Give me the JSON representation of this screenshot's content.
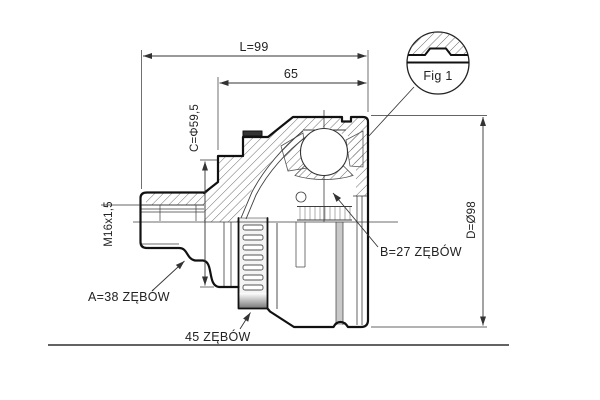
{
  "drawing": {
    "title_dimensions": {
      "length_total": "L=99",
      "length_inner": "65",
      "diameter_c": "C=Φ59,5",
      "thread_spec": "M16x1,5",
      "diameter_d": "D=Ø98"
    },
    "labels": {
      "spline_a": "A=38 ZĘBÓW",
      "spline_b": "B=27 ZĘBÓW",
      "abs_ring_teeth": "45 ZĘBÓW",
      "detail_figure": "Fig 1"
    },
    "colors": {
      "outline": "#111111",
      "thin_line": "#3d3d3d",
      "hatch": "#6e6e6e",
      "dim_text": "#222222",
      "gray_stripe": "#c9c9c9",
      "background": "#ffffff",
      "bottom_rule": "#4d4d4d"
    }
  }
}
